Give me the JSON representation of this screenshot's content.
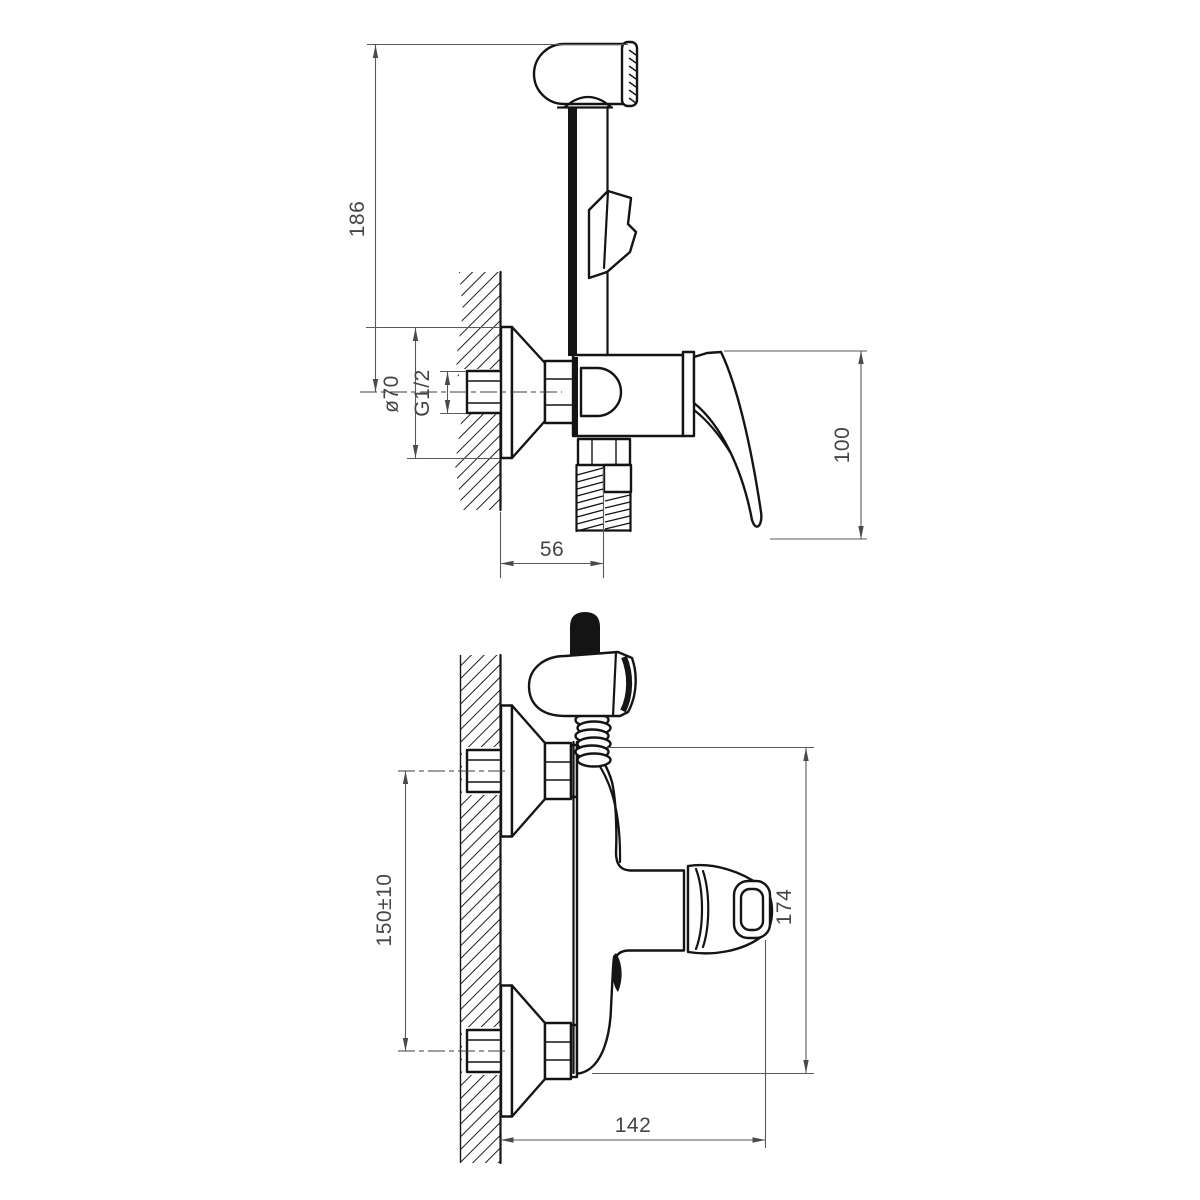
{
  "page": {
    "background_color": "#ffffff"
  },
  "drawing": {
    "object_line_color": "#141414",
    "dimension_line_color": "#5a5a5a",
    "views": [
      {
        "id": "side-view",
        "dimensions": [
          {
            "id": "height-to-shower-head",
            "label": "186"
          },
          {
            "id": "escutcheon-diameter",
            "label": "ø70"
          },
          {
            "id": "inlet-thread-size",
            "label": "G1/2"
          },
          {
            "id": "handle-height",
            "label": "100"
          },
          {
            "id": "wall-to-hose-outlet",
            "label": "56"
          }
        ]
      },
      {
        "id": "front-view",
        "dimensions": [
          {
            "id": "inlet-center-distance",
            "label": "150±10"
          },
          {
            "id": "overall-height",
            "label": "174"
          },
          {
            "id": "wall-to-handle-front",
            "label": "142"
          }
        ]
      }
    ]
  }
}
